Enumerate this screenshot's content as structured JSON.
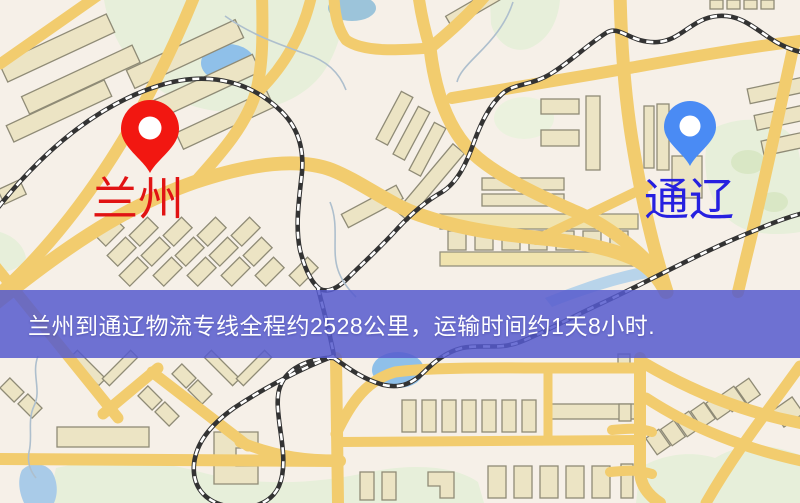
{
  "map": {
    "origin": {
      "label": "兰州",
      "pin": "red-pin-icon",
      "pin_color": "#f21711",
      "label_color": "#e11313"
    },
    "destination": {
      "label": "通辽",
      "pin": "blue-pin-icon",
      "pin_color": "#4a8bf4",
      "label_color": "#2620e0"
    },
    "banner": {
      "text": "兰州到通辽物流专线全程约2528公里，运输时间约1天8小时.",
      "background": "#565ace",
      "text_color": "#ffffff"
    },
    "route": {
      "distance_km": "2528",
      "duration": "1天8小时"
    }
  },
  "colors": {
    "map_base": "#f6f0e8",
    "road": "#f2cc6e",
    "park_green": "#e7efda",
    "water_blue": "#9fc6e7",
    "building_fill": "#ece4c4",
    "building_stroke": "#8f8b76",
    "railway": "#333333"
  }
}
